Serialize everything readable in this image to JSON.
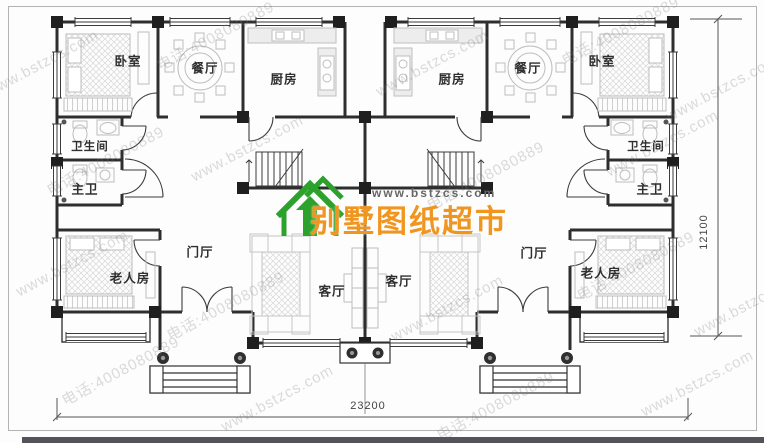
{
  "watermark": {
    "site": "www.bstzcs.com",
    "phone": "电话:4008080889"
  },
  "logo": {
    "brand": "别墅图纸超市",
    "url": "www.bstzcs.com"
  },
  "rooms": [
    {
      "id": "bedroom-left",
      "label": "卧室"
    },
    {
      "id": "dining-left",
      "label": "餐厅"
    },
    {
      "id": "kitchen-left",
      "label": "厨房"
    },
    {
      "id": "kitchen-right",
      "label": "厨房"
    },
    {
      "id": "dining-right",
      "label": "餐厅"
    },
    {
      "id": "bedroom-right",
      "label": "卧室"
    },
    {
      "id": "bathroom-left",
      "label": "卫生间"
    },
    {
      "id": "master-bath-left",
      "label": "主卫"
    },
    {
      "id": "bathroom-right",
      "label": "卫生间"
    },
    {
      "id": "master-bath-right",
      "label": "主卫"
    },
    {
      "id": "elder-room-left",
      "label": "老人房"
    },
    {
      "id": "foyer-left",
      "label": "门厅"
    },
    {
      "id": "living-left",
      "label": "客厅"
    },
    {
      "id": "living-right",
      "label": "客厅"
    },
    {
      "id": "foyer-right",
      "label": "门厅"
    },
    {
      "id": "elder-room-right",
      "label": "老人房"
    }
  ],
  "dimensions": {
    "width": "23200",
    "height": "12100"
  },
  "colors": {
    "wall": "#2e2e2e",
    "brand_orange": "#f0951f",
    "logo_green": "#2ca12c",
    "watermark_gray": "#7a7a7a",
    "bottom_bar": "#55535a"
  }
}
